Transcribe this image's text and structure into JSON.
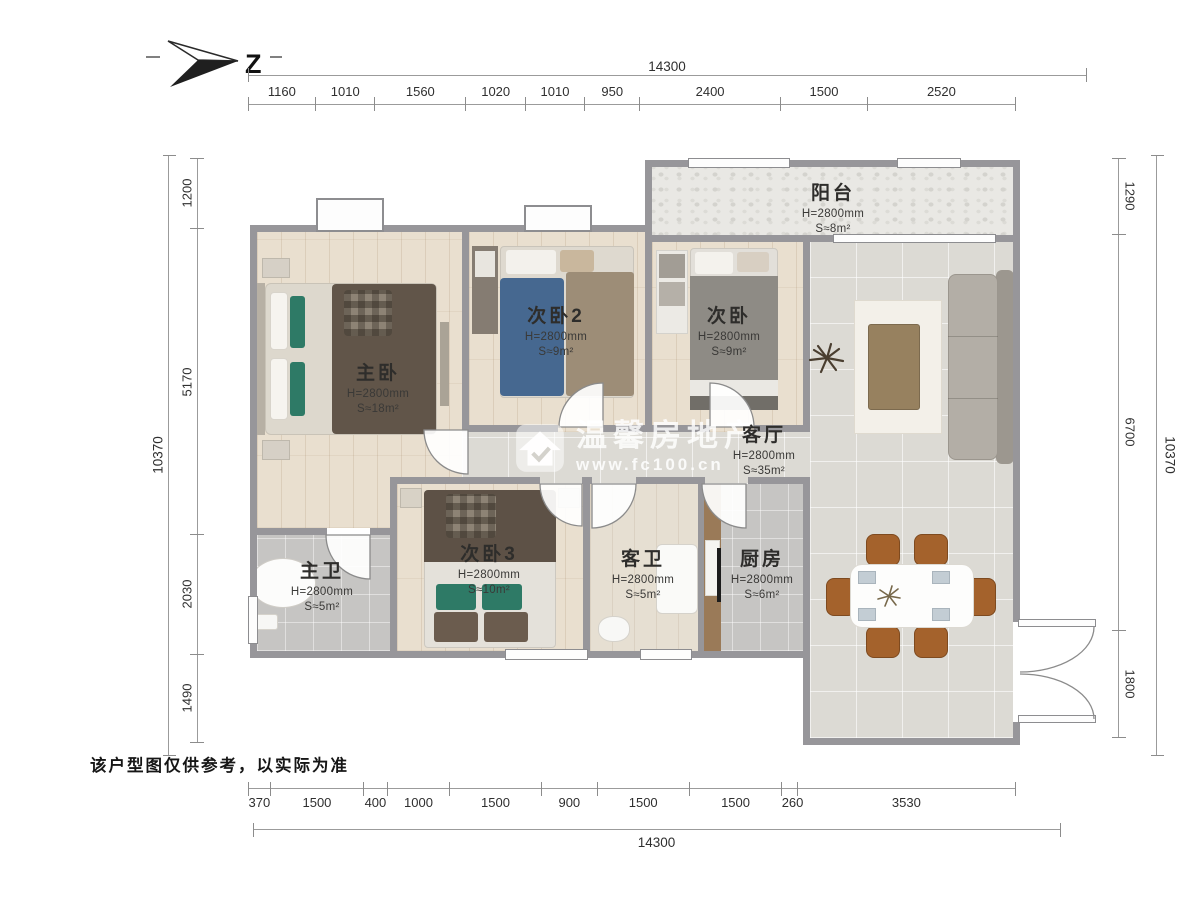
{
  "compass": {
    "label": "Z"
  },
  "watermark": {
    "brand": "温馨房地产",
    "url": "www.fc100.cn",
    "icon": "house-icon"
  },
  "disclaimer": "该户型图仅供参考，以实际为准",
  "dimensions": {
    "top": {
      "total": "14300",
      "segments": [
        1160,
        1010,
        1560,
        1020,
        1010,
        950,
        2400,
        1500,
        2520
      ]
    },
    "bottom": {
      "total": "14300",
      "segments": [
        370,
        1500,
        400,
        1000,
        1500,
        900,
        1500,
        1500,
        260,
        3530
      ]
    },
    "left": {
      "total": "10370",
      "segments": [
        1200,
        5170,
        2030,
        1490
      ]
    },
    "right": {
      "total": "10370",
      "segments": [
        1290,
        6700,
        1800
      ]
    }
  },
  "rooms": [
    {
      "id": "master-bedroom",
      "name": "主卧",
      "height": "H=2800mm",
      "area": "S≈18m²"
    },
    {
      "id": "bedroom-2",
      "name": "次卧2",
      "height": "H=2800mm",
      "area": "S≈9m²"
    },
    {
      "id": "bedroom",
      "name": "次卧",
      "height": "H=2800mm",
      "area": "S≈9m²"
    },
    {
      "id": "balcony",
      "name": "阳台",
      "height": "H=2800mm",
      "area": "S≈8m²"
    },
    {
      "id": "living-room",
      "name": "客厅",
      "height": "H=2800mm",
      "area": "S≈35m²"
    },
    {
      "id": "master-bath",
      "name": "主卫",
      "height": "H=2800mm",
      "area": "S≈5m²"
    },
    {
      "id": "bedroom-3",
      "name": "次卧3",
      "height": "H=2800mm",
      "area": "S≈10m²"
    },
    {
      "id": "guest-bath",
      "name": "客卫",
      "height": "H=2800mm",
      "area": "S≈5m²"
    },
    {
      "id": "kitchen",
      "name": "厨房",
      "height": "H=2800mm",
      "area": "S≈6m²"
    }
  ],
  "colors": {
    "wall": "#97969a",
    "wood_floor": "#e9dfcf",
    "tile_floor": "#dcdad4",
    "bath_tile": "#c6c5c3",
    "balcony": "#e9e8e4",
    "teal_pillow": "#2e7a66",
    "chair": "#a4622c",
    "counter": "#9a7a58",
    "blanket": "#615549"
  }
}
